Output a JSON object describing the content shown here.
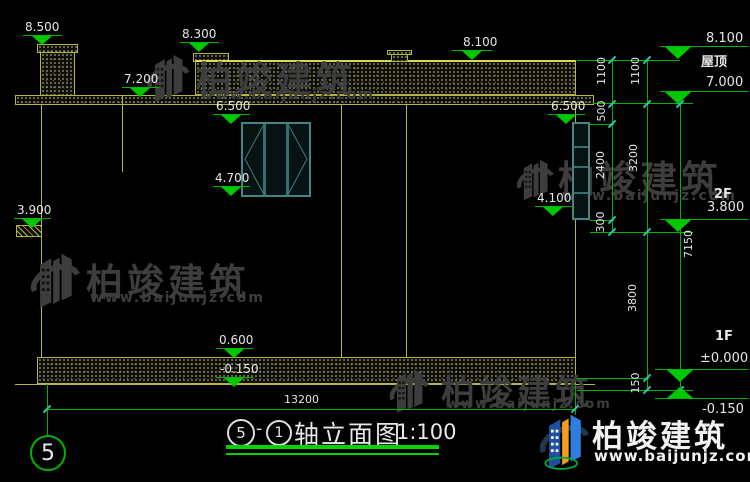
{
  "brand": {
    "name": "柏竣建筑",
    "site": "www.baijunjz.com"
  },
  "drawing_markers": {
    "chimney_top": "8.500",
    "parapet_left": "8.300",
    "eave_left": "7.200",
    "window_mid_top": "6.500",
    "window_mid_sill": "4.700",
    "ledge_left": "3.900",
    "roof_top": "8.100",
    "window_right_top": "6.500",
    "window_right_sill": "4.100",
    "plinth_top": "0.600",
    "ground_left": "-0.150"
  },
  "levels": {
    "parapet": "8.100",
    "roof_name": "屋顶",
    "roof": "7.000",
    "floor2_name": "2F",
    "floor2": "3.800",
    "floor1_name": "1F",
    "floor1": "±0.000",
    "ground": "-0.150"
  },
  "dims": {
    "total_width": "13200",
    "seg_1100_a": "1100",
    "seg_1100_b": "1100",
    "seg_500": "500",
    "seg_2400": "2400",
    "seg_300": "300",
    "seg_3200": "3200",
    "seg_3800": "3800",
    "seg_150": "150",
    "overall_7150": "7150"
  },
  "title": {
    "axis_a": "5",
    "dash": "-",
    "axis_b": "1",
    "name": "轴立面图",
    "scale": "1:100"
  },
  "grid": {
    "axis_bubble": "5"
  },
  "colors": {
    "cad_line_yellow": "#b4b440",
    "dimension_green": "#00b400",
    "tick_teal": "#2cc8b6",
    "text_white": "#e6e6e6",
    "watermark_gray": "#3d3d3d",
    "logo_blue": "#2e7de0",
    "logo_orange": "#f49c20"
  }
}
